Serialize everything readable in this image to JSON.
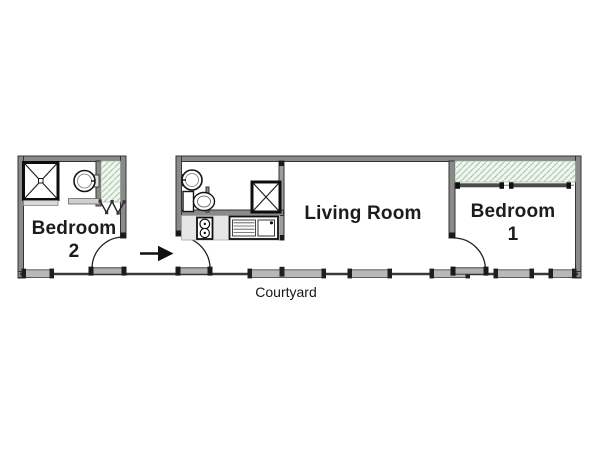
{
  "title": "Apartment floor plan",
  "rooms": {
    "bedroom2": {
      "line1": "Bedroom",
      "line2": "2"
    },
    "living_room": {
      "label": "Living Room"
    },
    "bedroom1": {
      "line1": "Bedroom",
      "line2": "1"
    },
    "courtyard": {
      "label": "Courtyard"
    }
  },
  "entry": {
    "arrow_direction": "right"
  },
  "fixtures": [
    "shower-stall-bedroom2",
    "washbasin-bedroom2",
    "closet-bifold-bedroom2",
    "washbasin-wc",
    "toilet-wc",
    "shower-stall-kitchen",
    "stove-two-burners",
    "kitchen-sink-with-drainboard",
    "closet-rails-bedroom1"
  ],
  "doors": [
    "bedroom2-entry-door",
    "main-entry-door",
    "bedroom1-door"
  ],
  "windows_courtyard_side": 6,
  "colors": {
    "wall": "#8a8a8a",
    "wall_edge": "#333333",
    "window_bar": "#b8b8b8",
    "window_cap": "#1f1f1f",
    "hatch_bg": "#eff5ef",
    "hatch_line": "#b4cab4",
    "counter": "#e6e6e6",
    "fixture_stroke": "#141414",
    "text": "#1c1c1c"
  }
}
